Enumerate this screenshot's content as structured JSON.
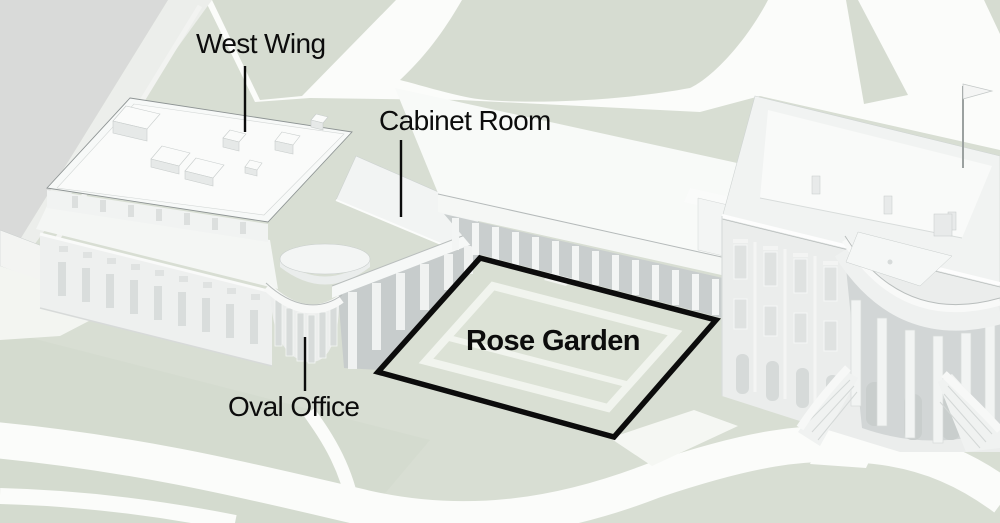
{
  "figure": {
    "labels": {
      "west_wing": "West Wing",
      "cabinet_room": "Cabinet Room",
      "rose_garden": "Rose Garden",
      "oval_office": "Oval Office"
    }
  },
  "colors": {
    "lawn": "#d8ded3",
    "lawn_shade": "#d2d8cc",
    "path": "#fbfcfa",
    "road": "#d9dad9",
    "ink": "#0c0c0c",
    "building_light": "#f7f9f8",
    "building_shade": "#e9eceb",
    "recess": "#c9cece"
  }
}
